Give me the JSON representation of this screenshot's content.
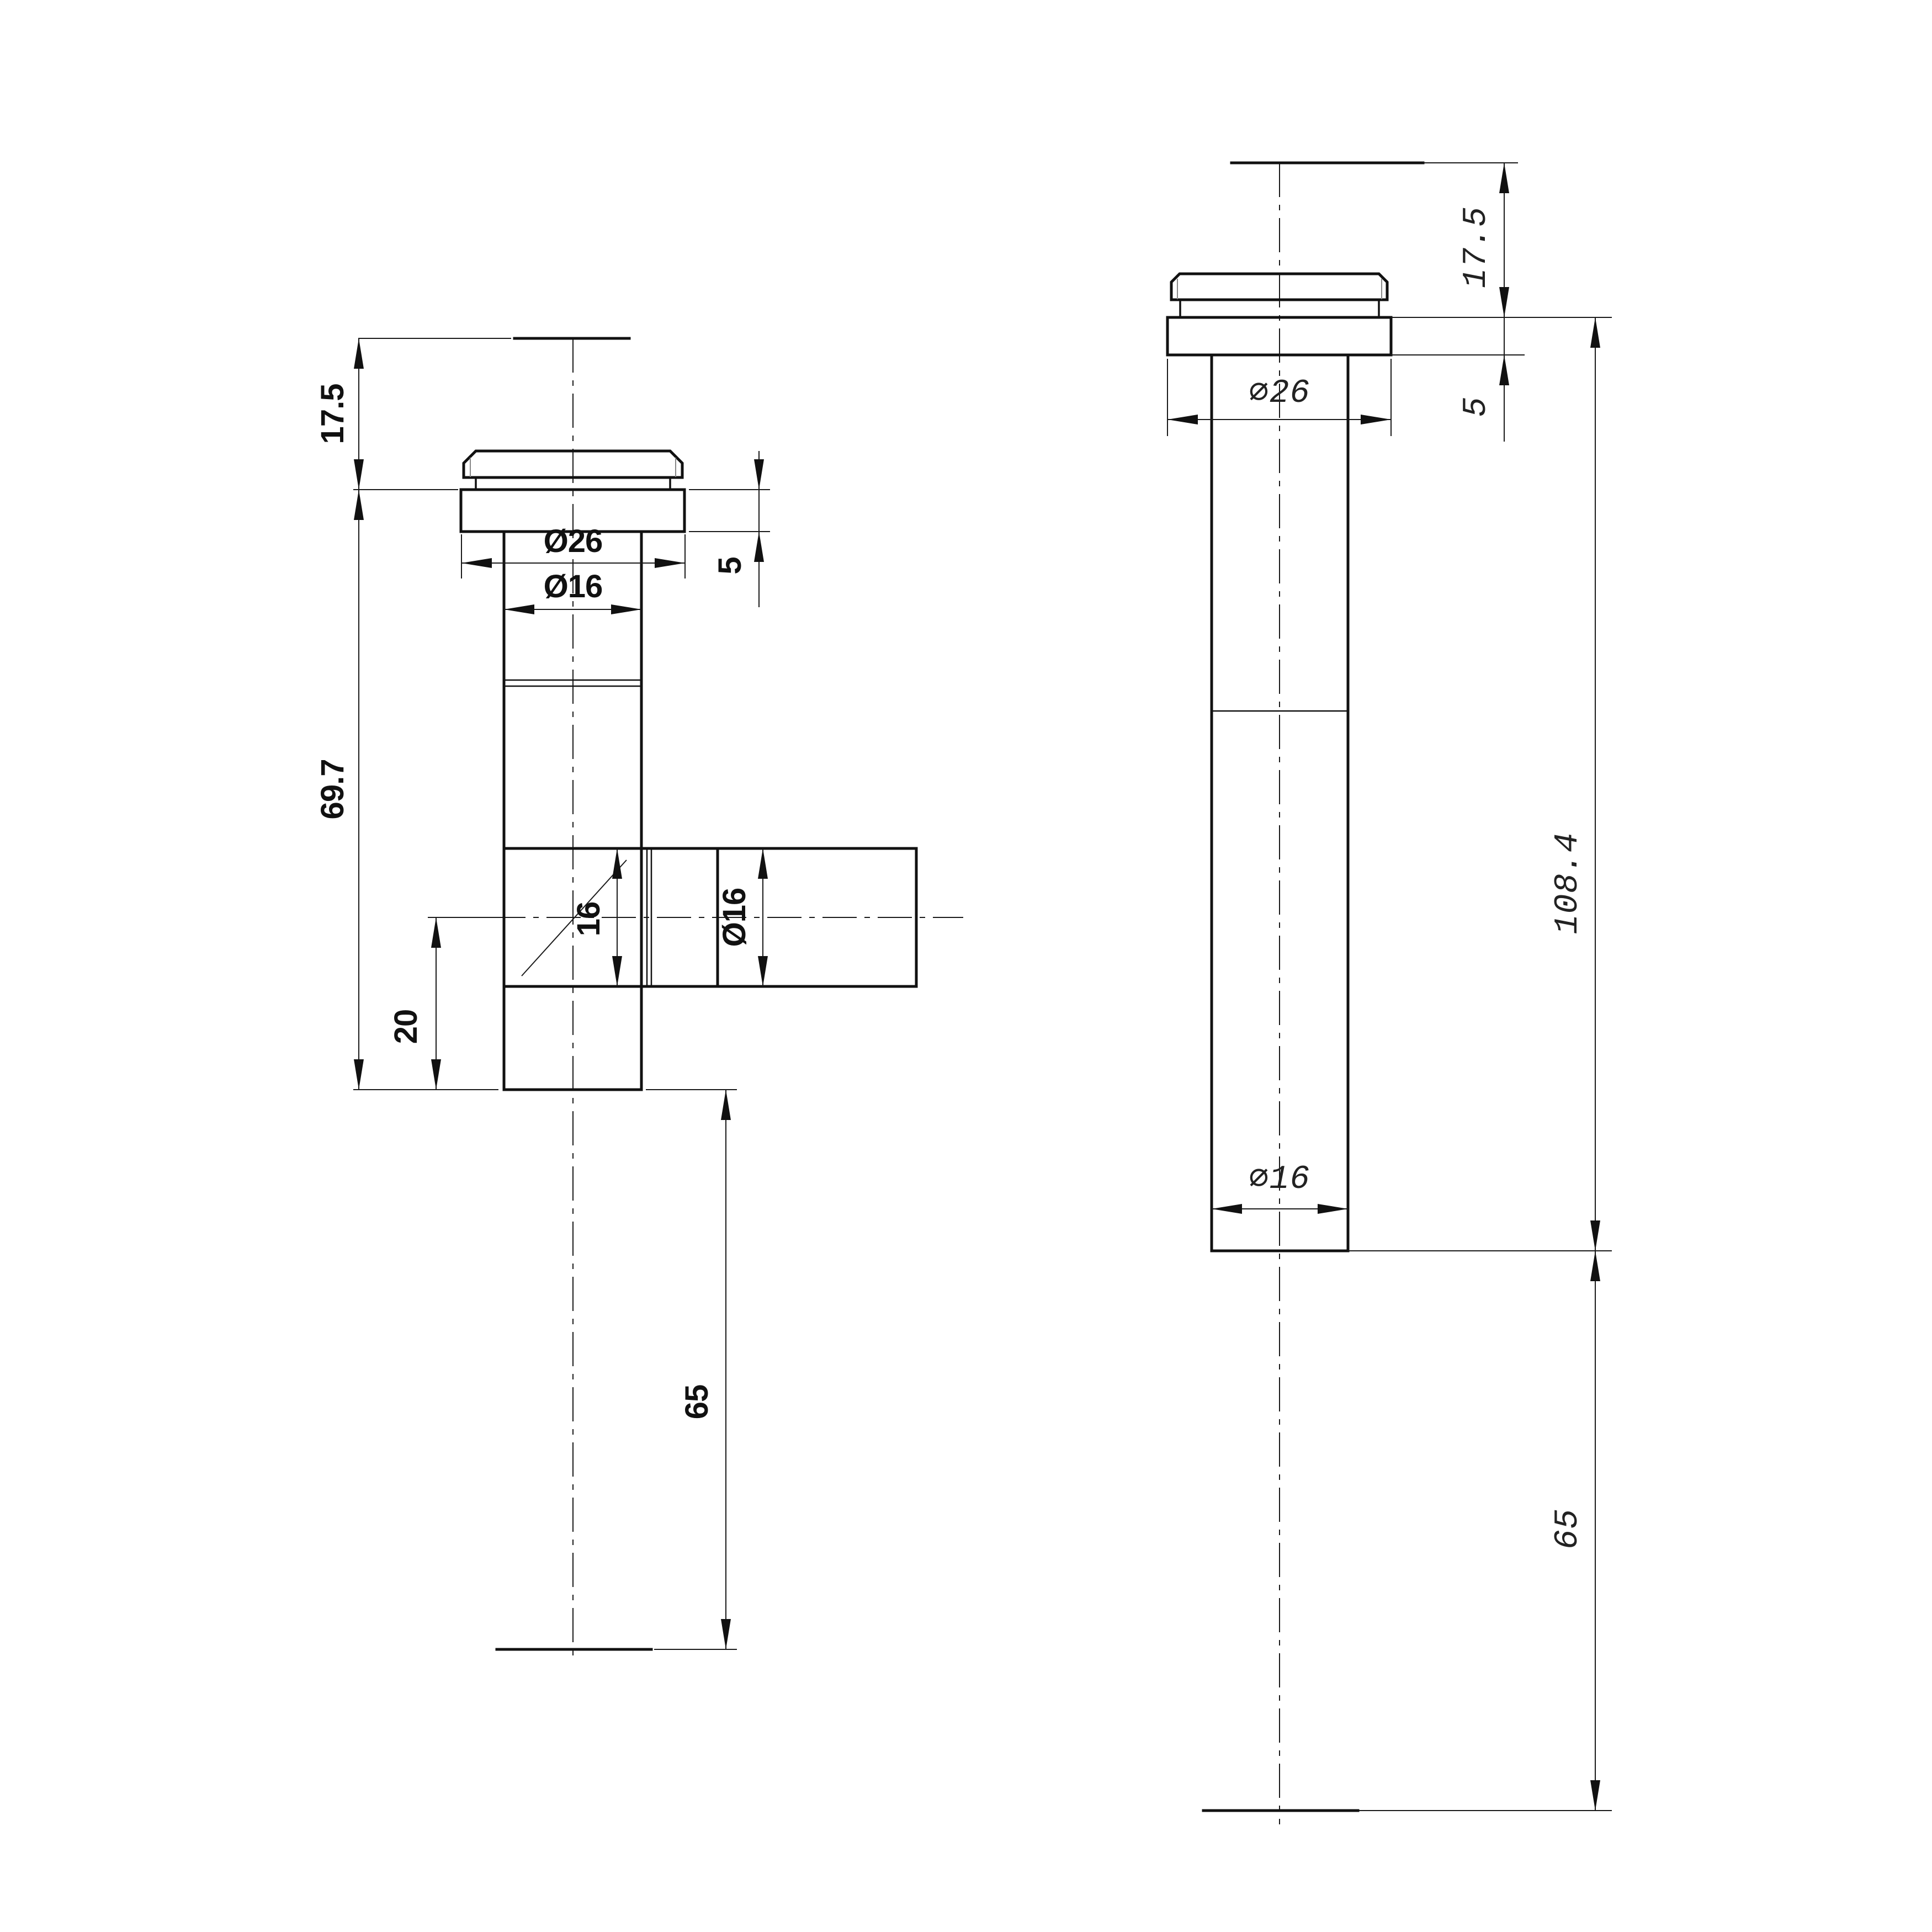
{
  "page": {
    "background_color": "#ffffff",
    "line_color": "#111111",
    "description": "two-view technical drawing of faucet tee fitting"
  },
  "front_view": {
    "dims": {
      "cap_height": "17.5",
      "body_length": "69.7",
      "branch_offset": "20",
      "inlet_length": "65",
      "flange_thickness": "5",
      "flange_diameter": "Ø26",
      "tube_diameter": "Ø16",
      "branch_bore": "16",
      "branch_diameter": "Ø16"
    }
  },
  "side_view": {
    "dims": {
      "cap_height": "17.5",
      "flange_thickness": "5",
      "flange_diameter": "∅26",
      "body_length": "108.4",
      "tube_diameter": "∅16",
      "inlet_length": "65"
    }
  }
}
